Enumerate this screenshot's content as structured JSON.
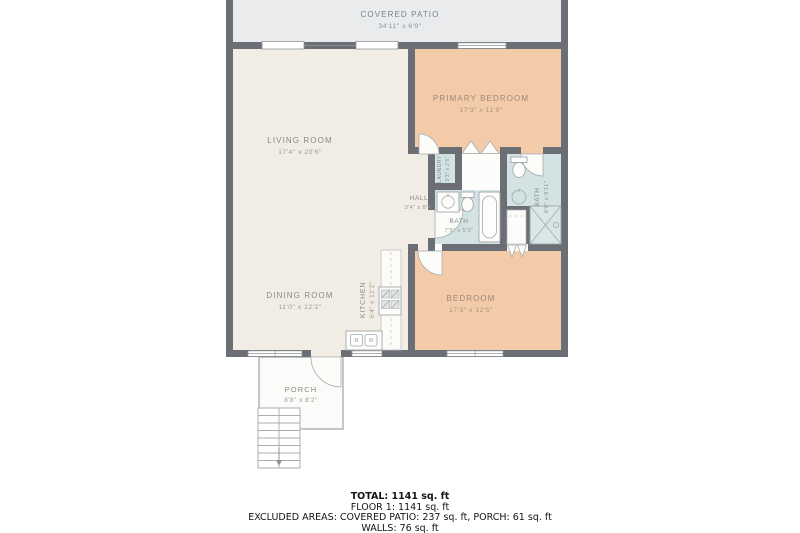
{
  "rooms": {
    "covered_patio": {
      "name": "COVERED PATIO",
      "dims": "34'11\" x 6'9\""
    },
    "living_room": {
      "name": "LIVING ROOM",
      "dims": "17'4\" x 20'6\""
    },
    "primary_bedroom": {
      "name": "PRIMARY BEDROOM",
      "dims": "17'3\" x 11'9\""
    },
    "hall": {
      "name": "HALL",
      "dims": "3'4\" x 8'4\""
    },
    "laundry": {
      "name": "LAUNDRY",
      "dims": "3'3\" x 2'6\""
    },
    "bath": {
      "name": "BATH",
      "dims": "7'5\" x 5'2\""
    },
    "bath_2": {
      "name": "BATH",
      "dims": "6'0\" x 9'11\""
    },
    "bedroom": {
      "name": "BEDROOM",
      "dims": "17'3\" x 12'5\""
    },
    "dining_room": {
      "name": "DINING ROOM",
      "dims": "11'0\" x 12'2\""
    },
    "kitchen": {
      "name": "KITCHEN",
      "dims": "6'4\" x 12'2\""
    },
    "porch": {
      "name": "PORCH",
      "dims": "8'8\" x 8'2\""
    }
  },
  "summary": {
    "total": "TOTAL: 1141 sq. ft",
    "floor_1": "FLOOR 1: 1141 sq. ft",
    "excluded_areas": "EXCLUDED AREAS: COVERED PATIO: 237 sq. ft, PORCH: 61 sq. ft",
    "walls": "WALLS: 76 sq. ft"
  },
  "colors": {
    "wall": "#6b6e74",
    "bedroom_fill": "#f3cba9",
    "living_fill": "#f1ede4",
    "bath_fill": "#d3e3e3",
    "patio_fill": "#e9ebed",
    "porch_fill": "#fbfbf9"
  }
}
